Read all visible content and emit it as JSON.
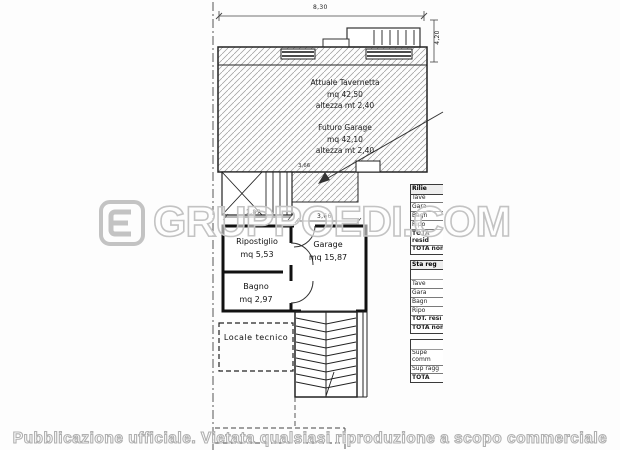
{
  "plan": {
    "dimensions": {
      "top_width": "8,30",
      "right_height": "4,20",
      "stair_width": "1,87",
      "hatch_opening": "3,66",
      "garage_front": "3,66"
    },
    "areas": {
      "tavernetta": {
        "line1": "Attuale Tavernetta",
        "line2": "mq 42,50",
        "line3": "altezza mt 2,40"
      },
      "futuro_garage": {
        "line1": "Futuro Garage",
        "line2": "mq 42,10",
        "line3": "altezza mt 2,40"
      },
      "ripostiglio": {
        "name": "Ripostiglio",
        "mq": "mq 5,53"
      },
      "garage": {
        "name": "Garage",
        "mq": "mq 15,87"
      },
      "bagno": {
        "name": "Bagno",
        "mq": "mq 2,97"
      },
      "locale_tecnico": {
        "name": "Locale tecnico"
      }
    }
  },
  "side_tables": [
    {
      "header": "Rilie",
      "rows": [
        "Tave",
        "Gara",
        "Bagn",
        "Ripo",
        "TOTA resid",
        "TOTA non"
      ]
    },
    {
      "header": "Sta reg",
      "rows": [
        "Tave",
        "Gara",
        "Bagn",
        "Ripo",
        "TOT. resi",
        "TOTA non"
      ]
    },
    {
      "header": "",
      "rows": [
        "Supe comm",
        "Sup ragg",
        "TOTA"
      ]
    }
  ],
  "watermark": {
    "text": "GRUPPOEDI.COM"
  },
  "footer": {
    "text": "Pubblicazione ufficiale. Vietata qualsiasi riproduzione a scopo commerciale"
  }
}
